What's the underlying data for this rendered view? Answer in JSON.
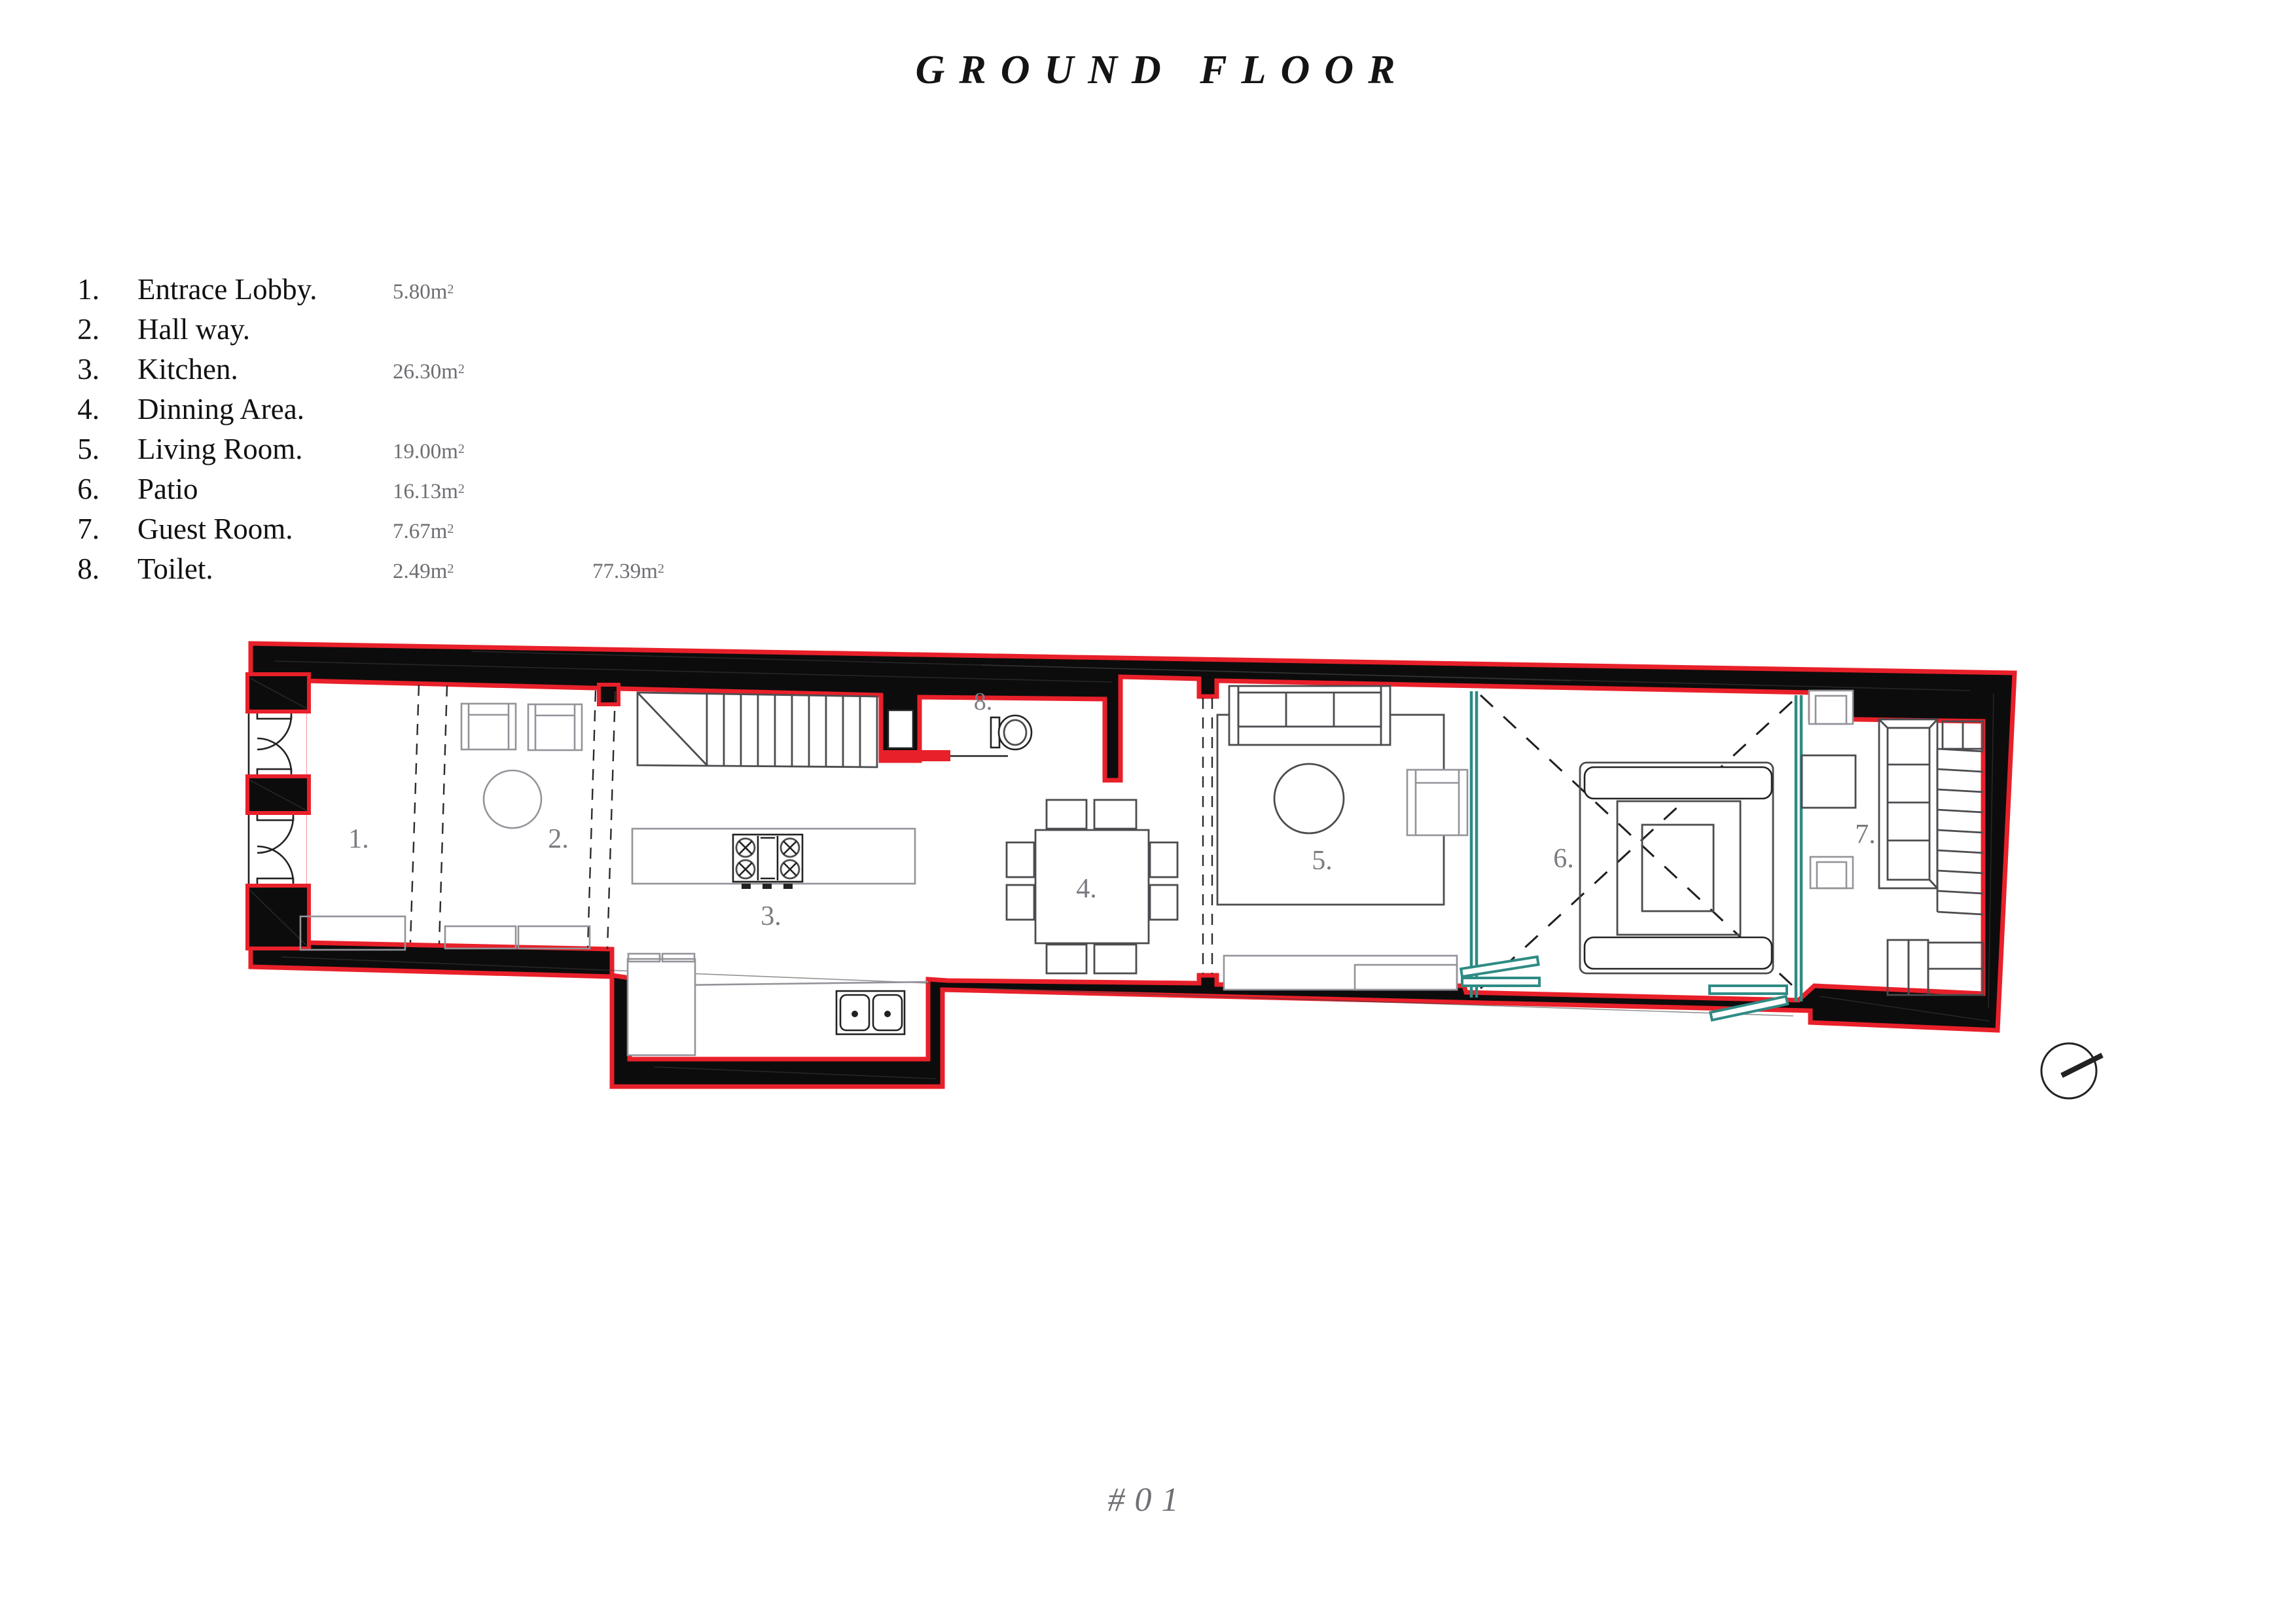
{
  "title": "GROUND FLOOR",
  "sheet_number": "#01",
  "legend": {
    "items": [
      {
        "num": "1.",
        "name": "Entrace Lobby.",
        "area": "5.80m",
        "area_exp": "2"
      },
      {
        "num": "2.",
        "name": "Hall way.",
        "area": "",
        "area_exp": ""
      },
      {
        "num": "3.",
        "name": "Kitchen.",
        "area": "26.30m",
        "area_exp": "2"
      },
      {
        "num": "4.",
        "name": "Dinning Area.",
        "area": "",
        "area_exp": ""
      },
      {
        "num": "5.",
        "name": "Living Room.",
        "area": "19.00m",
        "area_exp": "2"
      },
      {
        "num": "6.",
        "name": "Patio",
        "area": "16.13m",
        "area_exp": "2"
      },
      {
        "num": "7.",
        "name": "Guest Room.",
        "area": "7.67m",
        "area_exp": "2"
      },
      {
        "num": "8.",
        "name": "Toilet.",
        "area": "2.49m",
        "area_exp": "2"
      }
    ],
    "total_area": "77.39m",
    "total_area_exp": "2"
  },
  "plan": {
    "room_labels": [
      "1.",
      "2.",
      "3.",
      "4.",
      "5.",
      "6.",
      "7.",
      "8."
    ]
  },
  "colors": {
    "wall_red": "#e8202a",
    "glass_teal": "#2e8b84",
    "label_gray": "#7b7b80",
    "area_gray": "#6e6e73"
  }
}
